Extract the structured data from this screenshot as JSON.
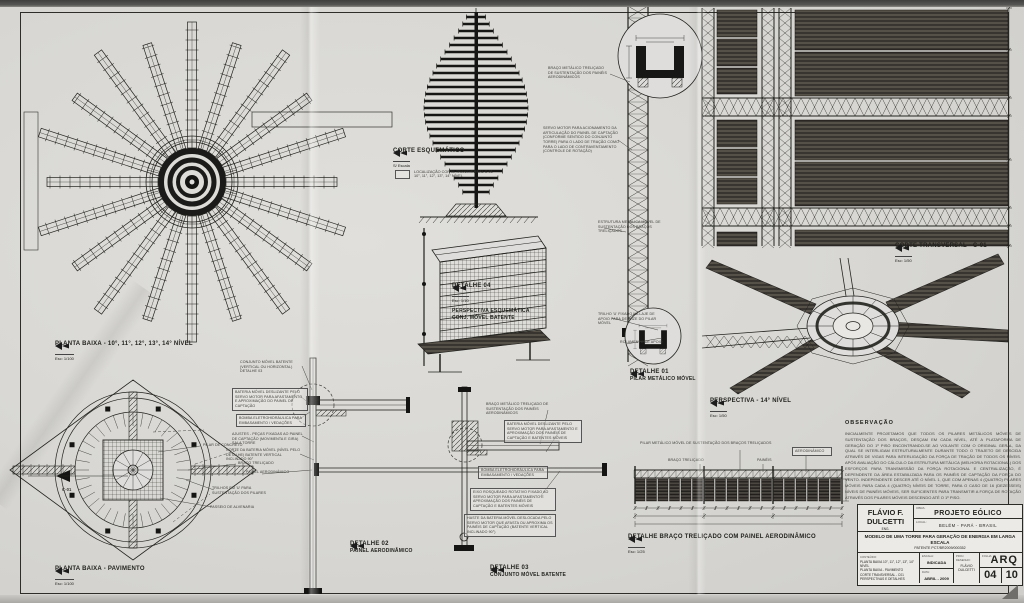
{
  "captions": {
    "planta_niveis": {
      "title": "PLANTA BAIXA - 10°, 11°, 12°, 13°, 14° NÍVEL",
      "scale": "Esc: 1/100"
    },
    "planta_pavimento": {
      "title": "PLANTA BAIXA - PAVIMENTO",
      "scale": "Esc: 1/100"
    },
    "corte_esquematico": {
      "title": "CORTE ESQUEMÁTICO",
      "scale": "S/ Escala"
    },
    "detalhe04": {
      "title": "DETALHE 04",
      "scale": "Esc: 1/10",
      "line2": "PERSPECTIVA ESQUEMÁTICA",
      "line3": "CONJ. MÓVEL BATENTE"
    },
    "detalhe02": {
      "title": "DETALHE 02",
      "scale": "Esc: 1/10",
      "line2": "PAINEL AERODINÂMICO"
    },
    "detalhe03": {
      "title": "DETALHE 03",
      "scale": "Esc: 1/10",
      "line2": "CONJUNTO MÓVEL BATENTE"
    },
    "detalhe01": {
      "title": "DETALHE 01",
      "scale": "Esc: 1/10",
      "line2": "PILAR METÁLICO MÓVEL"
    },
    "corte_transversal": {
      "title": "CORTE TRANSVERSAL - C-01",
      "scale": "Esc: 1/50"
    },
    "perspectiva": {
      "title": "PERSPECTIVA - 14° NÍVEL",
      "scale": "Esc: 1/50"
    },
    "braco_trelicado": {
      "title": "DETALHE BRAÇO TRELIÇADO COM PAINEL AERODINÂMICO",
      "scale": "Esc: 1/25"
    }
  },
  "legend": {
    "line1": "LOCALIZAÇÃO CORTE TRANSVERSAL C-01",
    "line2": "10°, 11°, 12°, 13°, 14° NÍVEL"
  },
  "annotations": {
    "braco_sust": "BRAÇO METÁLICO TRELIÇADO DE SUSTENTAÇÃO DOS PAINÉIS AERODINÂMICOS",
    "servo": "SERVO MOTOR PARA ACIONAMENTO DA ARTICULAÇÃO DO PAINEL DE CAPTAÇÃO (CONFORME SENTIDO DO CONJUNTO TORRE) PARA O LADO DE TRAÇÃO COMO PARA O LADO DE CONTRAVENTAMENTO (CONTROLE DE ROTAÇÃO)",
    "estrutura": "ESTRUTURA METÁLICA MÓVEL DE SUSTENTAÇÃO DOS BRAÇOS TRELIÇADOS",
    "trilho_u": "TRILHO 'U' FIXADO NA LAJE DE APOIO PARA DESLIZE DO PILAR MÓVEL",
    "rolamento": "ROLAMENTO DE APOIO",
    "conj_movel": "CONJUNTO MÓVEL BATENTE (VERTICAL OU HORIZONTAL) DETALHE 03",
    "bateria1": "BATERIA MÓVEL DESLIZANTE PELO SERVO MOTOR PARA AFASTAMENTO E APROXIMAÇÃO DO PAINEL DE CAPTAÇÃO",
    "bomba1": "BOMBA ELETROHIDRÁULICA PARA EMBASAMENTO / VEDAÇÕES",
    "ajustes": "AJUSTES - PEÇAS FIXADAS AO PAINEL DE CAPTAÇÃO (MOVIMENTA E GIRA) SALA TORRE",
    "corte_bateria": "CORTE DA BATERIA MÓVEL (NÍVEL PELO DETALHE) BATENTE VERTICAL INCLINADO 90°",
    "painel_aero": "PAINEL AERODINÂMICO",
    "braco_sust2": "BRAÇO METÁLICO TRELIÇADO DE SUSTENTAÇÃO DOS PAINÉIS AERODINÂMICOS",
    "bateria2": "BATERIA MÓVEL DESLIZANTE PELO SERVO MOTOR PARA AFASTAMENTO E APROXIMAÇÃO DOS PAINÉIS DE CAPTAÇÃO E BATENTES MÓVEIS",
    "bomba2": "BOMBA ELETROHIDRÁULICA PARA EMBASAMENTO / VEDAÇÕES",
    "eixo": "EIXO ROSQUEADO ROTATIVO FIXADO AO SERVO MOTOR PARA AFASTAMENTO E APROXIMAÇÃO DOS PAINÉIS DE CAPTAÇÃO E BATENTES MÓVEIS",
    "haste": "HASTE DA BATERIA MÓVEL DESLOCADA PELO SERVO MOTOR QUE AFASTA OU APROXIMA OS PAINÉIS DE CAPTAÇÃO (BATENTE VERTICAL INCLINADO 90°)",
    "pilar_concreto": "PILAR DE CONCRETO",
    "braco_trel": "BRAÇO TRELIÇADO",
    "trilhos_u": "TRILHOS EM 'U' PARA SUSTENTAÇÃO DOS PILARES",
    "passeio": "PASSEIO DE ALVENARIA",
    "c01": "C-01",
    "braco_top": "PILAR METÁLICO MÓVEL DE SUSTENTAÇÃO DOS BRAÇOS TRELIÇADOS",
    "braco_lbl": "BRAÇO TRELIÇADO",
    "paineis_lbl": "PAINÉIS",
    "aero_lbl": "AERODINÂMICO"
  },
  "observacao": {
    "title": "OBSERVAÇÃO",
    "body": "INICIALMENTE PROJETAMOS QUE TODOS OS PILARES METÁLICOS MÓVEIS DE SUSTENTAÇÃO DOS BRAÇOS, DESÇAM EM CADA NÍVEL, ATÉ A PLATAFORMA DE GERAÇÃO DO 1º PISO ENCONTRANDO-SE AO VOLANTE COM O ORIGINAL GERAL, DA QUAL SE INTERLIGAM ESTRUTURALMENTE DURANTE TODO O TRAJETO DE DESCIDA ATRAVÉS DE VIGAS PARA INTERLIGAÇÃO DA FORÇA DE TRAÇÃO DE TODOS OS NÍVEIS. APÓS AVALIAÇÃO DO CÁLCULO DA ESTRUTURA METÁLICA (MELHORIA ROTACIONAL) DOS ESFORÇOS PARA TRANSMISSÃO DA FORÇA ROTACIONAL E CENTRALIZAÇÃO, É DEPENDENTE DA ÁREA ESTABILIZADA PARA OS PAINÉIS DE CAPTAÇÃO DA FORÇA DO VENTO. INDEPENDENTE DESCER ATÉ O NÍVEL 1, QUE COM APENAS 4 (QUATRO) PILARES MÓVEIS PARA CADA 4 (QUATRO) NÍVEIS DE TORRE, PARA O CASO DE 16 (DEZESSEIS) NÍVEIS DE PAINÉIS MÓVEIS, SER SUFICIENTES PARA TRANSMITIR A FORÇA DE ROTAÇÃO ATRAVÉS DOS PILARES MÓVEIS DESCENDO ATÉ O 1º PISO."
  },
  "titleblock": {
    "author_name": "FLÁVIO F. DULCETTI",
    "author_sub": "ENG.",
    "obra_label": "OBRA:",
    "obra": "PROJETO EÓLICO",
    "local_label": "LOCAL:",
    "local": "BELÉM - PARÁ - BRASIL",
    "descricao": "MODELO DE UMA TORRE PARA GERAÇÃO DE ENERGIA EM LARGA ESCALA",
    "patente": "PATENTE PCT/BR2009/000352",
    "conteudo_label": "CONTEÚDO:",
    "conteudo_lines": [
      "PLANTA BAIXA 10°, 11°, 12°, 13°, 14° NÍVEL",
      "PLANTA BAIXA - PAVIMENTO",
      "CORTE TRANSVERSAL - C01",
      "PERSPECTIVAS E DETALHES"
    ],
    "escala_label": "ESCALA:",
    "escala": "INDICADA",
    "data_label": "DATA:",
    "data": "ABRIL - 2009",
    "resp_label": "PROJ. DESENHO:",
    "resp": "FLÁVIO DULCETTI",
    "folha_label": "FOLHA:",
    "sigla": "ARQ",
    "num": "04",
    "total": "10"
  }
}
